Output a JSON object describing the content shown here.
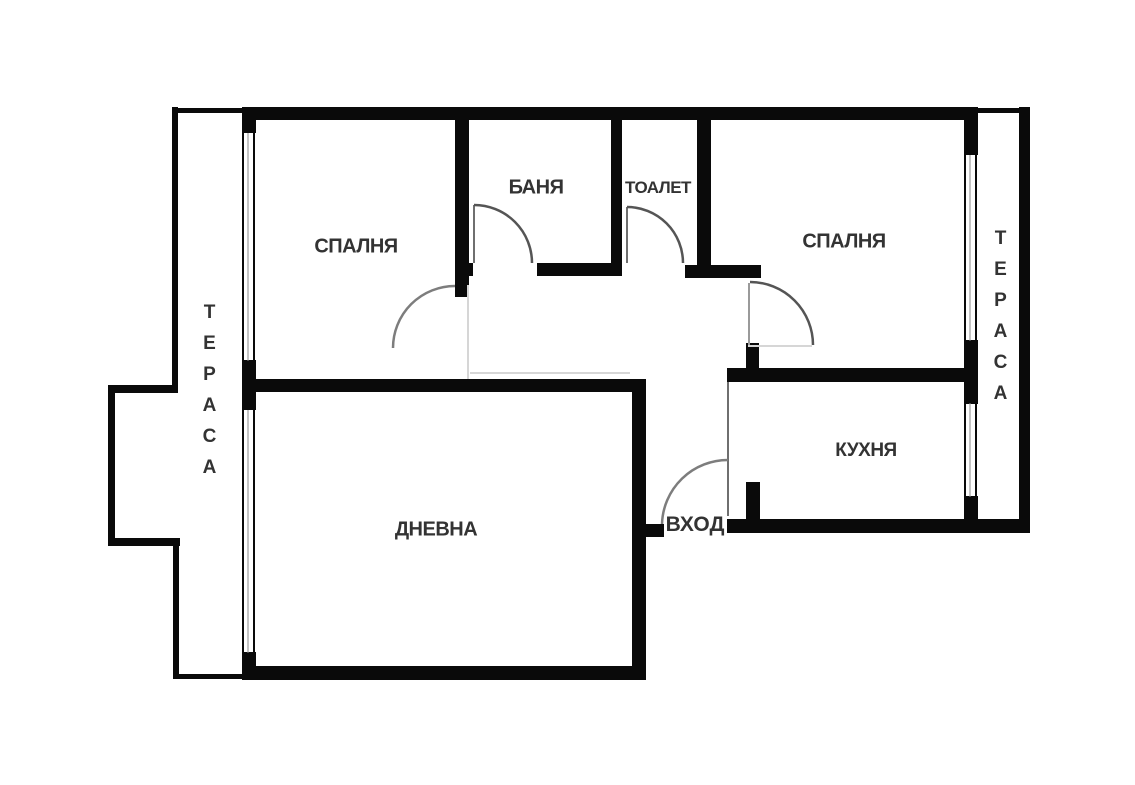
{
  "colors": {
    "background": "#ffffff",
    "wall": "#0a0a0a",
    "label_text": "#333333",
    "door_arc": "#555555",
    "ghost_line": "#d6d6d6"
  },
  "plan": {
    "labels": {
      "bedroom_left": "СПАЛНЯ",
      "bathroom": "БАНЯ",
      "toilet": "ТОАЛЕТ",
      "bedroom_right": "СПАЛНЯ",
      "kitchen": "КУХНЯ",
      "living_room": "ДНЕВНА",
      "entrance": "ВХОД",
      "terrace_left": "ТЕРАСА",
      "terrace_right": "ТЕРАСА"
    }
  }
}
